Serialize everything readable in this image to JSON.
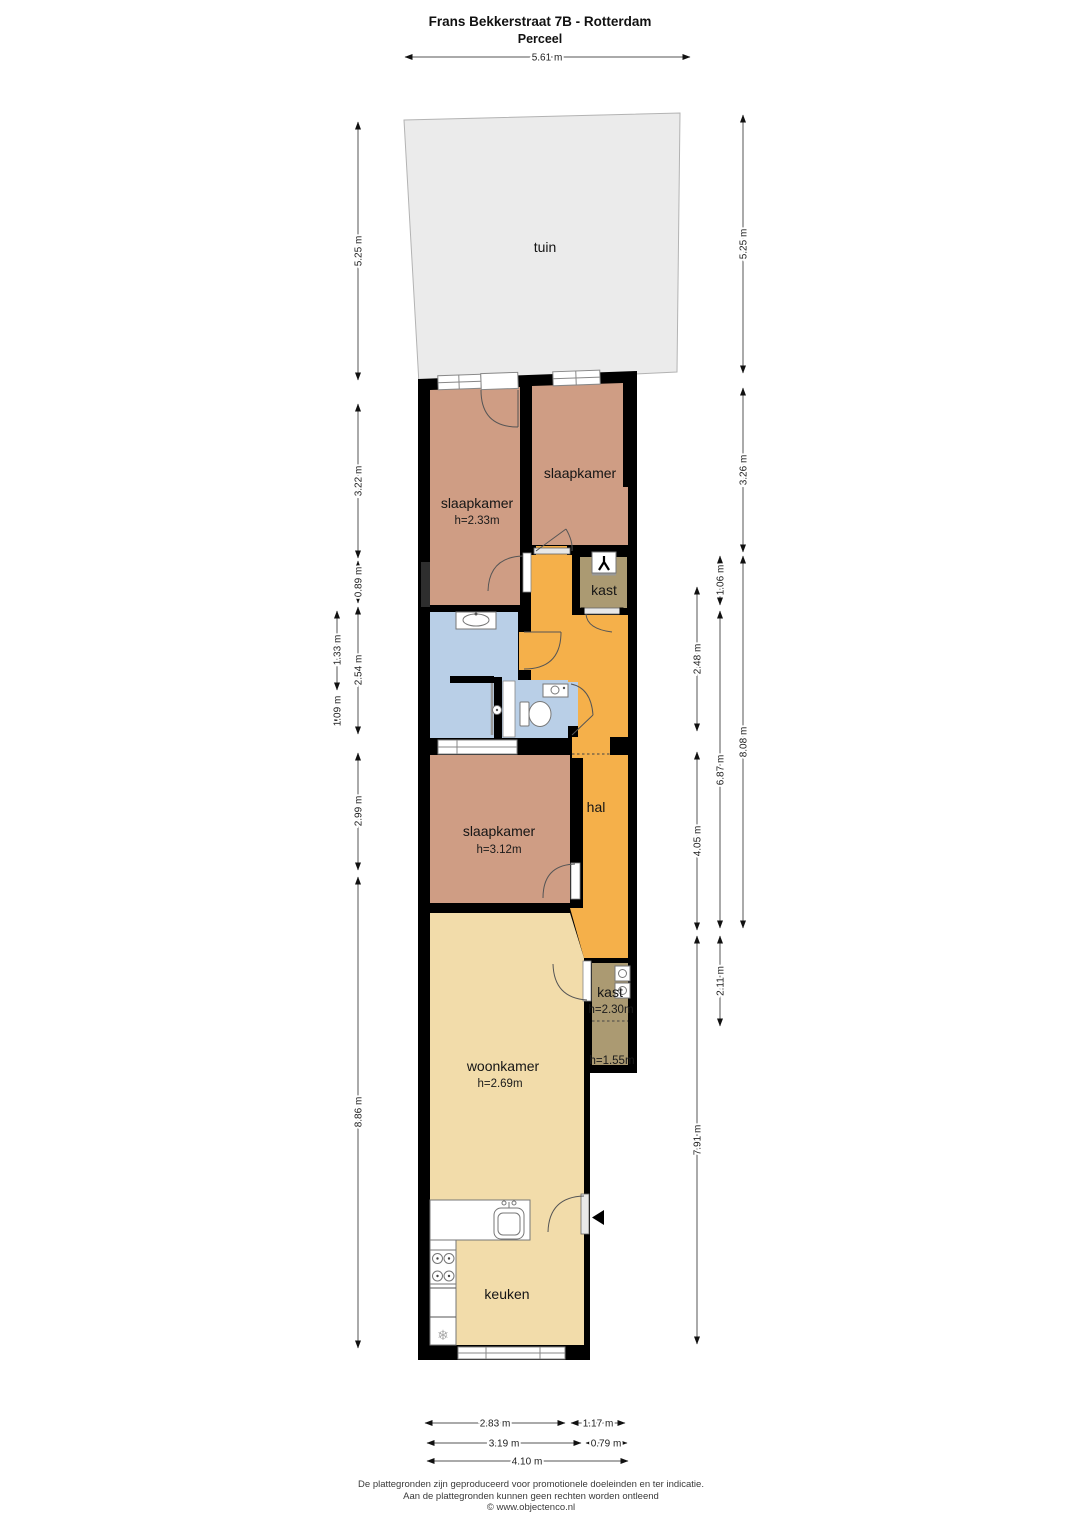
{
  "page_title": {
    "line1": "Frans Bekkerstraat 7B - Rotterdam",
    "line2": "Perceel"
  },
  "rooms": {
    "tuin": {
      "label": "tuin"
    },
    "slaapkamer1": {
      "label": "slaapkamer",
      "height": "h=2.33m"
    },
    "slaapkamer2": {
      "label": "slaapkamer"
    },
    "kast1": {
      "label": "kast"
    },
    "hal": {
      "label": "hal"
    },
    "slaapkamer3": {
      "label": "slaapkamer",
      "height": "h=3.12m"
    },
    "kast2": {
      "label": "kast",
      "height_front": "h=2.30m",
      "height_back": "h=1.55m"
    },
    "woonkamer": {
      "label": "woonkamer",
      "height": "h=2.69m"
    },
    "keuken": {
      "label": "keuken"
    }
  },
  "dims": {
    "top_width": "5.61 m",
    "tuin_left": "5.25 m",
    "tuin_right": "5.25 m",
    "left_3_22": "3.22 m",
    "left_0_89": "0.89 m",
    "left_2_54": "2.54 m",
    "left_1_33": "1.33 m",
    "left_1_09": "1.09 m",
    "left_2_99": "2.99 m",
    "left_8_86": "8.86 m",
    "right_3_26": "3.26 m",
    "right_8_08": "8.08 m",
    "right_1_06": "1.06 m",
    "right_6_87": "6.87 m",
    "right_2_11": "2.11 m",
    "right_2_48": "2.48 m",
    "right_4_05": "4.05 m",
    "right_7_91": "7.91 m",
    "bottom_2_83": "2.83 m",
    "bottom_1_17": "1.17 m",
    "bottom_3_19": "3.19 m",
    "bottom_0_79": "0.79 m",
    "bottom_4_10": "4.10 m"
  },
  "icons": {
    "snowflake": "❄"
  },
  "footer": {
    "line1": "De plattegronden zijn geproduceerd voor promotionele doeleinden en ter indicatie.",
    "line2": "Aan de plattegronden kunnen geen rechten worden ontleend",
    "line3": "© www.objectenco.nl"
  },
  "colors": {
    "wall": "#000000",
    "bedroom": "#cf9d84",
    "hall": "#f5b04a",
    "closet": "#ab9a72",
    "bathroom": "#b9cfe7",
    "living": "#f2dcaa",
    "garden": "#ebebeb"
  }
}
